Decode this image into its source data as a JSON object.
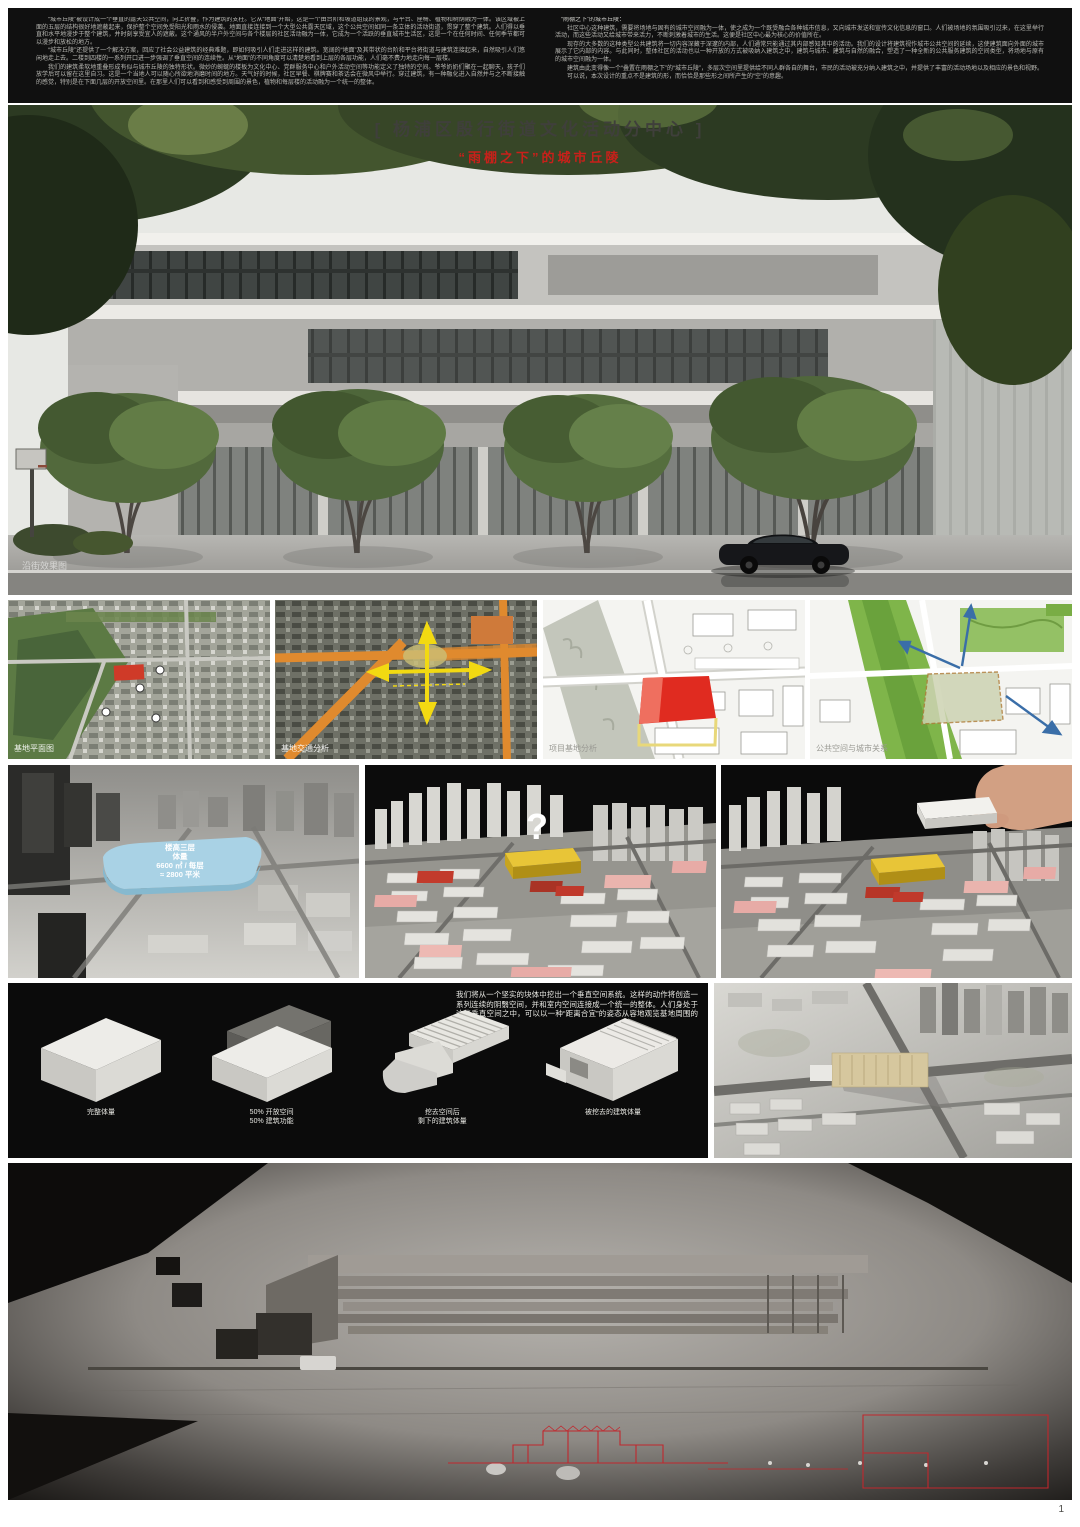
{
  "poster": {
    "title": "[ 杨浦区殷行街道文化活动分中心 ]",
    "subtitle": "“雨棚之下”的城市丘陵",
    "page_number": "1"
  },
  "header": {
    "left_column": [
      "“城市丘陵”被设计成一个垂直的露天公共空间，向上折叠，作为建筑的支柱。它从“地面”开始，这是一个由台阶和坡道组成的景观，与平台、座椅、植物和树荫融为一体。该区域被上面的五层的结构很好地遮蔽起来，保护整个空间免受阳光和雨水的侵袭。地面直接连接到一个大型公共露天区域，这个公共空间如同一条立体的活动街道，贯穿了整个建筑。人们得以垂直和水平地漫步于整个建筑，并时刻享受宜人的遮蔽。这个通风的半户外空间与各个楼层的社区活动融为一体，它成为一个活跃的垂直城市生活区，这是一个在任何时间、任何季节都可以漫步和放松的地方。",
      "“城市丘陵”还提供了一个解决方案，回应了社会公益建筑的经典难题，即如何吸引人们走进这样的建筑。宽阔的“地面”及其带状的台阶和平台将街道与建筑连接起来，自然吸引人们悠闲地走上去。二楼到四楼的一系列开口进一步强调了垂直空间的连续性。从“地面”的不同角度可以清楚地看到上层的各层功能，人们毫不费力地走向每一层楼。",
      "我们的建筑柔软地重叠形成有似与城市丘陵的独特形状。微妙的蜿蜒的楼板为文化中心、党群服务中心和户外活动空间等功能定义了独特的空间。爷爷奶奶们聚在一起聊天，孩子们放学后可以留在这里自习。这是一个当地人可以随心所欲地消磨时间的地方。天气好的时候，社区早餐、棋牌赛和茶话会在微风中举行。穿过建筑，有一种融化进入自然并与之不断接触的感觉，特别是在下面几层的开放空间里。在那里人们可以看到和感受到周围的景色，植物和每层楼的活动融为一个统一的整体。"
    ],
    "right_column": [
      "“雨棚之下”的城市丘陵：",
      "社区中心这种建筑，需要将场地与固有的城市空间融为一体，使之成为一个既受融合各种城市信息，又向城市发送和宣传文化信息的窗口。人们被场地的氛围吸引过来，在这里举行活动，而这些活动又给城市带来活力，不断刺激着城市的生活。这便是社区中心最为核心的价值所在。",
      "现存的大多数的这种类型公共建筑将一切内容深藏于深邃的内部，人们通常只能通过其内部感知其中的活动。我们的设计将建筑视作城市公共空间的延续，这使建筑面向外面的城市展示了它内部的内容。与此同时，整体社区的活动也以一种开放的方式被吸纳入建筑之中，建筑与城市、建筑与自然的融合，塑造了一种全新的公共服务建筑的空间类型，将场地与原有的城市空间融为一体。",
      "建筑由此变得像一个“叠置在雨棚之下”的“城市丘陵”，多层次空间里提供给不同人群各自的舞台，市民的活动被充分纳入建筑之中，并提供了丰富的活动场地以及相应的景色和视野。",
      "可以说，本次设计的重点不是建筑的形，而恰恰是那些形之间所产生的“空”的意趣。"
    ]
  },
  "hero": {
    "watermark": "沿街效果图"
  },
  "maps": [
    {
      "caption": "基地平面图"
    },
    {
      "caption": "基地交通分析"
    },
    {
      "caption": "项目基地分析"
    },
    {
      "caption": "公共空间与城市关系"
    }
  ],
  "models": [
    {
      "labels": [
        "楼高三层",
        "体量",
        "6600 ㎡ / 每层",
        "≈ 2800 平米"
      ]
    },
    {
      "mark": "?"
    },
    {
      "labels": []
    }
  ],
  "diagram_panel": {
    "description": "我们将从一个坚实的块体中挖出一个垂直空间系统。这样的动作将创造一系列连续的阴翳空间，并和室内空间连接成一个统一的整体。人们身处于这些垂直空间之中，可以以一种“距离合宜”的姿态从容地观览基地周围的景色。",
    "steps": [
      {
        "caption": "完整体量"
      },
      {
        "caption": "50% 开放空间\n50% 建筑功能"
      },
      {
        "caption": "挖去空间后\n剩下的建筑体量"
      },
      {
        "caption": "被挖去的建筑体量"
      }
    ]
  },
  "colors": {
    "accent_red": "#c9201a",
    "site_red": "#e02b20",
    "mass_blue": "#a9d2e5",
    "mass_yellow": "#e8c537",
    "road_orange": "#e08a2e",
    "park_green": "#7fb54a"
  }
}
